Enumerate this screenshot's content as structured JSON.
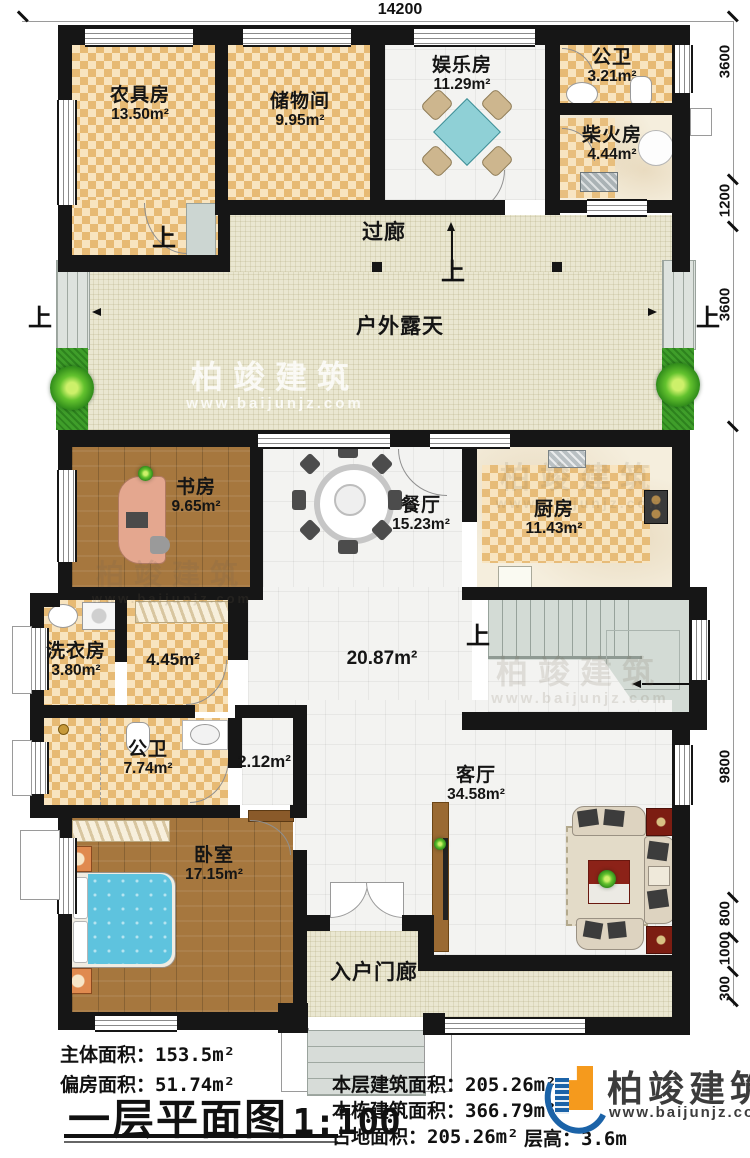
{
  "title": {
    "text": "一层平面图",
    "scale": "1:100"
  },
  "dims": {
    "top": "14200",
    "right": [
      "3600",
      "1200",
      "3600",
      "9800",
      "800",
      "1000",
      "300"
    ]
  },
  "up": "上",
  "rooms": {
    "farm_tool": {
      "name": "农具房",
      "area": "13.50m²"
    },
    "storage": {
      "name": "储物间",
      "area": "9.95m²"
    },
    "entertainment": {
      "name": "娱乐房",
      "area": "11.29m²"
    },
    "bath_top": {
      "name": "公卫",
      "area": "3.21m²"
    },
    "firewood": {
      "name": "柴火房",
      "area": "4.44m²"
    },
    "corridor": {
      "name": "过廊"
    },
    "terrace": {
      "name": "户外露天"
    },
    "study": {
      "name": "书房",
      "area": "9.65m²"
    },
    "dining": {
      "name": "餐厅",
      "area": "15.23m²"
    },
    "kitchen": {
      "name": "厨房",
      "area": "11.43m²"
    },
    "laundry": {
      "name": "洗衣房",
      "area": "3.80m²"
    },
    "hall_small": {
      "area": "4.45m²"
    },
    "bath_main": {
      "name": "公卫",
      "area": "7.74m²"
    },
    "passage": {
      "area": "2.12m²"
    },
    "hall_big": {
      "area": "20.87m²"
    },
    "bedroom": {
      "name": "卧室",
      "area": "17.15m²"
    },
    "living": {
      "name": "客厅",
      "area": "34.58m²"
    },
    "porch": {
      "name": "入户门廊"
    }
  },
  "summary": {
    "main_area_label": "主体面积：",
    "main_area_value": "153.5m²",
    "side_area_label": "偏房面积：",
    "side_area_value": "51.74m²",
    "floor_area_label": "本层建筑面积：",
    "floor_area_value": "205.26m²",
    "building_area_label": "本栋建筑面积：",
    "building_area_value": "366.79m²",
    "footprint_label": "占地面积：",
    "footprint_value": "205.26m²",
    "floor_height_label": "层高：",
    "floor_height_value": "3.6m"
  },
  "logo": {
    "name": "柏竣建筑",
    "url": "www.baijunjz.com"
  },
  "watermark": {
    "name": "柏竣建筑",
    "url": "www.baijunjz.com"
  },
  "colors": {
    "wall": "#161616",
    "checker": "#e7ba74",
    "wood": "#a6773e",
    "logo_blue": "#1b63a8",
    "logo_orange": "#f59a1d",
    "grass": "#3f9e2a"
  }
}
